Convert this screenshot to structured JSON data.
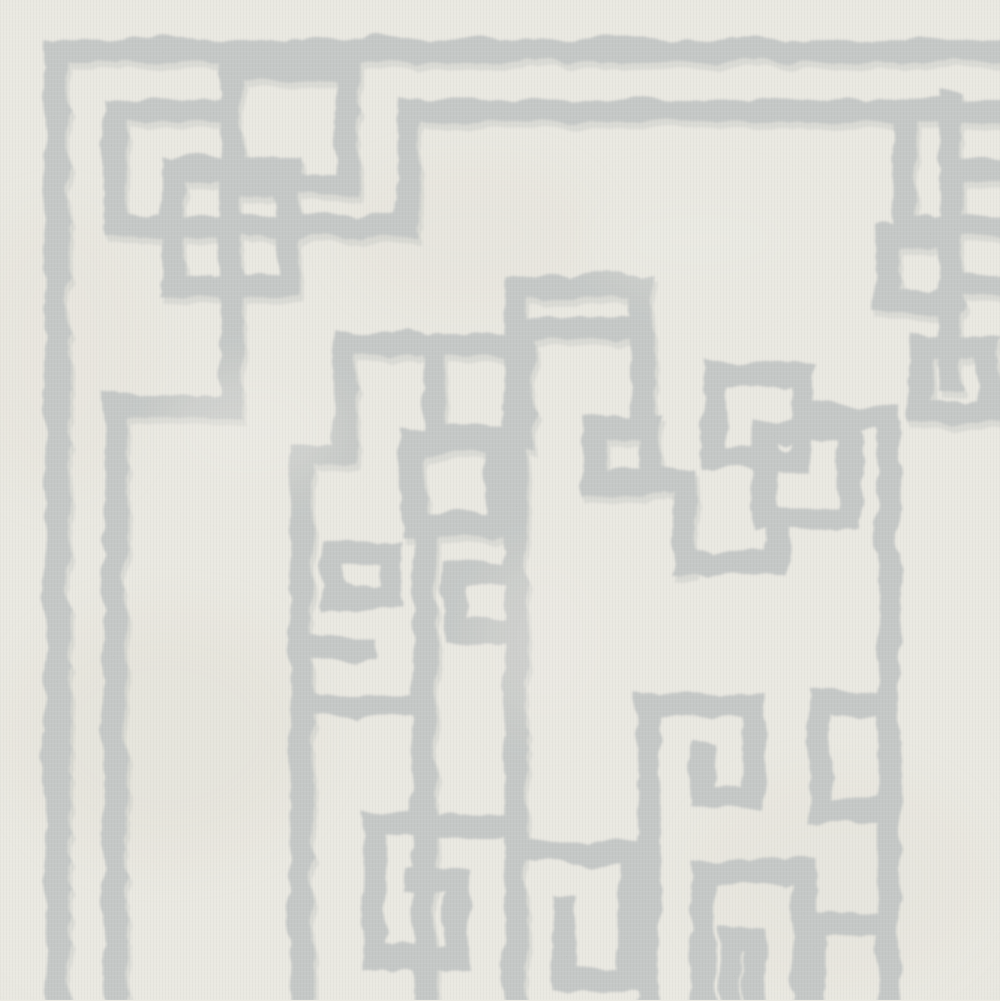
{
  "image": {
    "type": "photograph",
    "subject": "Close-up of a hand-tufted wool area rug",
    "alt_text": "Close-up of an ivory wool rug with a light gray Greek key fretwork pattern: a double border with interlocking square-knot corner motifs at the top left and top right, and a large geometric meander medallion filling the center and lower portion of the frame. The looped pile texture of the wool is visible throughout.",
    "visible_text": ""
  },
  "palette": {
    "background": "#ECEAE2",
    "background_warm": "#E3E0D3",
    "pattern_gray": "#B5BAB9",
    "pattern_gray_shadow": "#99A2A0",
    "speckle_light": "#FFFFFF",
    "speckle_dark": "#6E6E66"
  },
  "pattern": {
    "style": "Greek key / interlocking fretwork",
    "elements": [
      "outer-border-band",
      "inner-border-band",
      "interlocking-knot-corner-top-left",
      "interlocking-knot-corner-top-right",
      "greek-key-center-medallion",
      "wool-pile-texture"
    ]
  }
}
